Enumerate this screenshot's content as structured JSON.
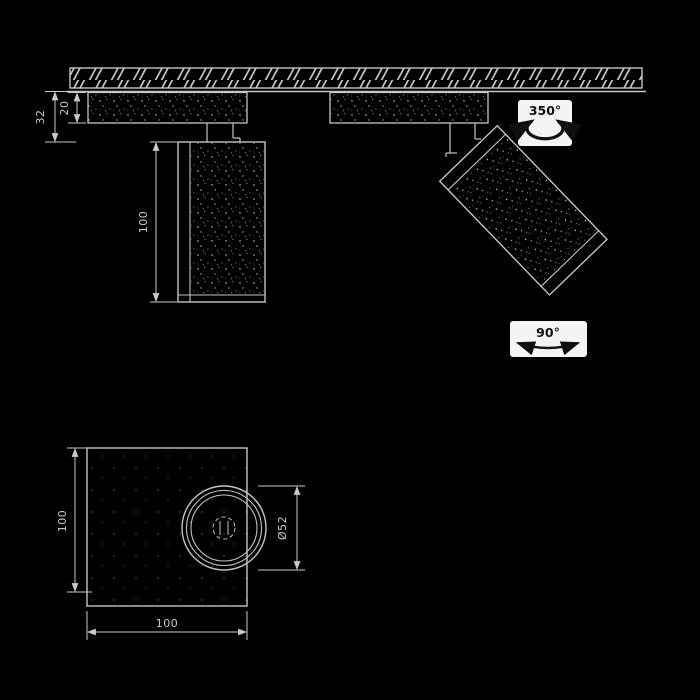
{
  "drawing": {
    "title": "ceiling-spotlight-installation-drawing",
    "section_view": {
      "dim_total_drop": "32",
      "dim_base_height": "20",
      "dim_body_length": "100",
      "pan_rotation_label": "350°",
      "tilt_rotation_label": "90°"
    },
    "bottom_view": {
      "dim_height": "100",
      "dim_width": "100",
      "dim_lens_diameter": "Ø52"
    },
    "colors": {
      "background": "#000000",
      "line": "#c4c4c4",
      "dim_text": "#c9c9c9",
      "symbol_box": "#f4f4f4",
      "symbol_ink": "#101010"
    }
  }
}
